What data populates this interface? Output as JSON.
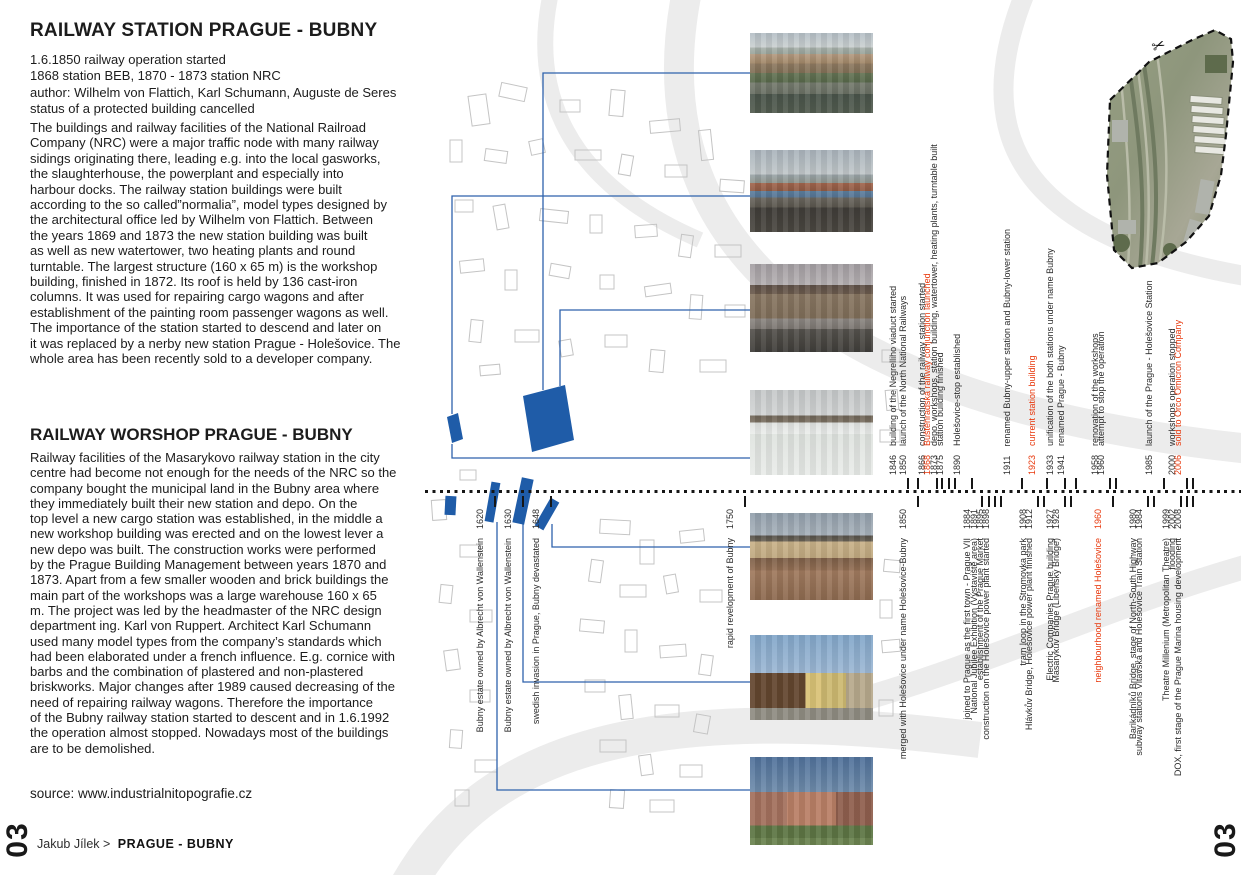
{
  "page": {
    "number": "03",
    "footer_author": "Jakub Jílek >",
    "footer_title": "PRAGUE - BUBNY",
    "source": "source: www.industrialnitopografie.cz"
  },
  "colors": {
    "accent_red": "#e8380c",
    "map_blue": "#1f5ca8"
  },
  "icons": {
    "scissors": "✂"
  },
  "station_section": {
    "title": "RAILWAY STATION PRAGUE - BUBNY",
    "meta": "1.6.1850 railway operation started\n1868 station BEB, 1870 - 1873 station NRC\nauthor: Wilhelm von Flattich, Karl Schumann, Auguste de Seres\nstatus of a protected building cancelled",
    "body": "The buildings and railway facilities of the National Railroad\nCompany (NRC) were a major traffic node with many railway\nsidings originating there, leading e.g. into the local gasworks,\nthe slaughterhouse, the powerplant and especially into\nharbour docks. The railway station buildings were built\naccording to the so called”normalia”, model types designed by\nthe architectural office led by Wilhelm von Flattich. Between\nthe years 1869 and 1873 the new station building was built\nas well as new watertower, two heating plants and round\nturntable. The largest structure (160 x 65 m) is the workshop\nbuilding, finished in 1872. Its roof is held by 136 cast-iron\ncolumns. It was used for repairing cargo wagons and after\nestablishment of the painting room passenger wagons as well.\nThe importance of the station started to descend and later on\nit was replaced by a nerby new station Prague - Holešovice. The\nwhole area has been recently sold to a developer company."
  },
  "workshop_section": {
    "title": "RAILWAY WORSHOP PRAGUE - BUBNY",
    "body": "Railway facilities of the Masarykovo railway station in the city\ncentre had become not enough for the needs of the NRC so the\ncompany bought the municipal land in the Bubny area where\nthey immediately built their new station and depo. On the\ntop level a new cargo station was established, in the middle a\nnew workshop building was erected and on the lowest lever a\nnew depo was built. The construction works were performed\nby the Prague Building Management between years 1870 and\n1873. Apart from a few smaller wooden and brick buildings the\nmain part of the workshops was a large warehouse 160 x 65\nm. The project was led by the headmaster of the NRC design\ndepartment ing. Karl von Ruppert. Architect Karl Schumann\nused many model types from the company’s standards which\nhad been elaborated under a french influence. E.g. cornice with\nbarbs and the combination of plastered and non-plastered\nbriskworks. Major changes after 1989 caused decreasing of the\nneed of repairing railway wagons. Therefore the importance\nof the Bubny railway station started to descent and in 1.6.1992\nthe operation almost stopped. Nowadays most of the buildings\nare to be demolished."
  },
  "timeline": {
    "top": [
      {
        "year": "1846",
        "label": "building of the Negrelliho viaduct started",
        "x": 908,
        "red": false
      },
      {
        "year": "1850",
        "label": "launch of the North National Railways",
        "x": 918,
        "red": false
      },
      {
        "year": "1866",
        "label": "construction of the railway station started",
        "x": 937,
        "red": false
      },
      {
        "year": "1868",
        "label": "Buštěhradská railway conjunction launched",
        "x": 942,
        "red": true
      },
      {
        "year": "1873",
        "label": "depo, workshops, station building, watertower, heating plants, turntable built",
        "x": 949,
        "red": false
      },
      {
        "year": "1875",
        "label": "station building finished",
        "x": 955,
        "red": false
      },
      {
        "year": "1890",
        "label": "Holešovice-stop established",
        "x": 972,
        "red": false
      },
      {
        "year": "1911",
        "label": "renamed Bubny-upper station and Bubny-lower station",
        "x": 1022,
        "red": false
      },
      {
        "year": "1923",
        "label": "current station building",
        "x": 1047,
        "red": true
      },
      {
        "year": "1933",
        "label": "unification of the both stations under name Bubny",
        "x": 1065,
        "red": false
      },
      {
        "year": "1941",
        "label": "renamed Prague - Bubny",
        "x": 1076,
        "red": false
      },
      {
        "year": "1958",
        "label": "renovation of the workshops",
        "x": 1110,
        "red": false
      },
      {
        "year": "1960",
        "label": "attempt to stop the operation",
        "x": 1116,
        "red": false
      },
      {
        "year": "1985",
        "label": "launch of the Prague - Holešovice Station",
        "x": 1164,
        "red": false
      },
      {
        "year": "2000",
        "label": "workshops operation stopped",
        "x": 1187,
        "red": false
      },
      {
        "year": "2006",
        "label": "sold to Orco Omicron Company",
        "x": 1193,
        "red": true
      }
    ],
    "bottom": [
      {
        "year": "1620",
        "label": "Bubny estate owned by Albrecht von Wallenstein",
        "x": 495,
        "red": false
      },
      {
        "year": "1630",
        "label": "Bubny estate owned by Albrecht von Wallenstein",
        "x": 523,
        "red": false
      },
      {
        "year": "1648",
        "label": "swedish invasion in Prague, Bubny devastated",
        "x": 551,
        "red": false
      },
      {
        "year": "1750",
        "label": "rapid revelopment of Bubny",
        "x": 745,
        "red": false
      },
      {
        "year": "1850",
        "label": "merged with Holešovice under name Holešovice-Bubny",
        "x": 918,
        "red": false
      },
      {
        "year": "1884",
        "label": "joined to Prague as the first town - Prague VII",
        "x": 982,
        "red": false
      },
      {
        "year": "1891",
        "label": "National Jubilee Exhibition (Výstaviště area)",
        "x": 989,
        "red": false
      },
      {
        "year": "1895",
        "label": "establishment of the Prague Market",
        "x": 995,
        "red": false
      },
      {
        "year": "1898",
        "label": "construction on the Holešovice power plant started",
        "x": 1001,
        "red": false
      },
      {
        "year": "1908",
        "label": "tram loop in the Stromovka park",
        "x": 1038,
        "red": false
      },
      {
        "year": "1912",
        "label": "Hlávkův Bridge, Holešovice power plant finished",
        "x": 1044,
        "red": false
      },
      {
        "year": "1927",
        "label": "Electric Companies Prague building",
        "x": 1065,
        "red": false
      },
      {
        "year": "1928",
        "label": "Masarykův Bridge (Libeňský Bridge)",
        "x": 1071,
        "red": false
      },
      {
        "year": "1960",
        "label": "neighbourhood renamed Holešovice",
        "x": 1113,
        "red": true
      },
      {
        "year": "1980",
        "label": "Barikádníků Bridge, stage of North-South Highway",
        "x": 1148,
        "red": false
      },
      {
        "year": "1984",
        "label": "subway stations Vltavská and Holešovice Train Station",
        "x": 1154,
        "red": false
      },
      {
        "year": "1999",
        "label": "Theatre Millenium (Metropolitan Theatre)",
        "x": 1181,
        "red": false
      },
      {
        "year": "2002",
        "label": "flooding",
        "x": 1187,
        "red": false
      },
      {
        "year": "2008",
        "label": "DOX, first stage of the Prague Marina housing development",
        "x": 1193,
        "red": false
      }
    ]
  },
  "photos": [
    {
      "desc": "panorama of Prague with Bubny railway area in front"
    },
    {
      "desc": "railway depot area with trains and workshop roofs"
    },
    {
      "desc": "Bubny station building with platforms"
    },
    {
      "desc": "workshop warehouse in winter with snow field"
    },
    {
      "desc": "depot building with circular window and rubble ground"
    },
    {
      "desc": "wooden barn and yellow station house"
    },
    {
      "desc": "long red workshop building with lawn"
    }
  ],
  "aerial": {
    "desc": "aerial view of the Bubny railway brownfield (cut-out)"
  }
}
